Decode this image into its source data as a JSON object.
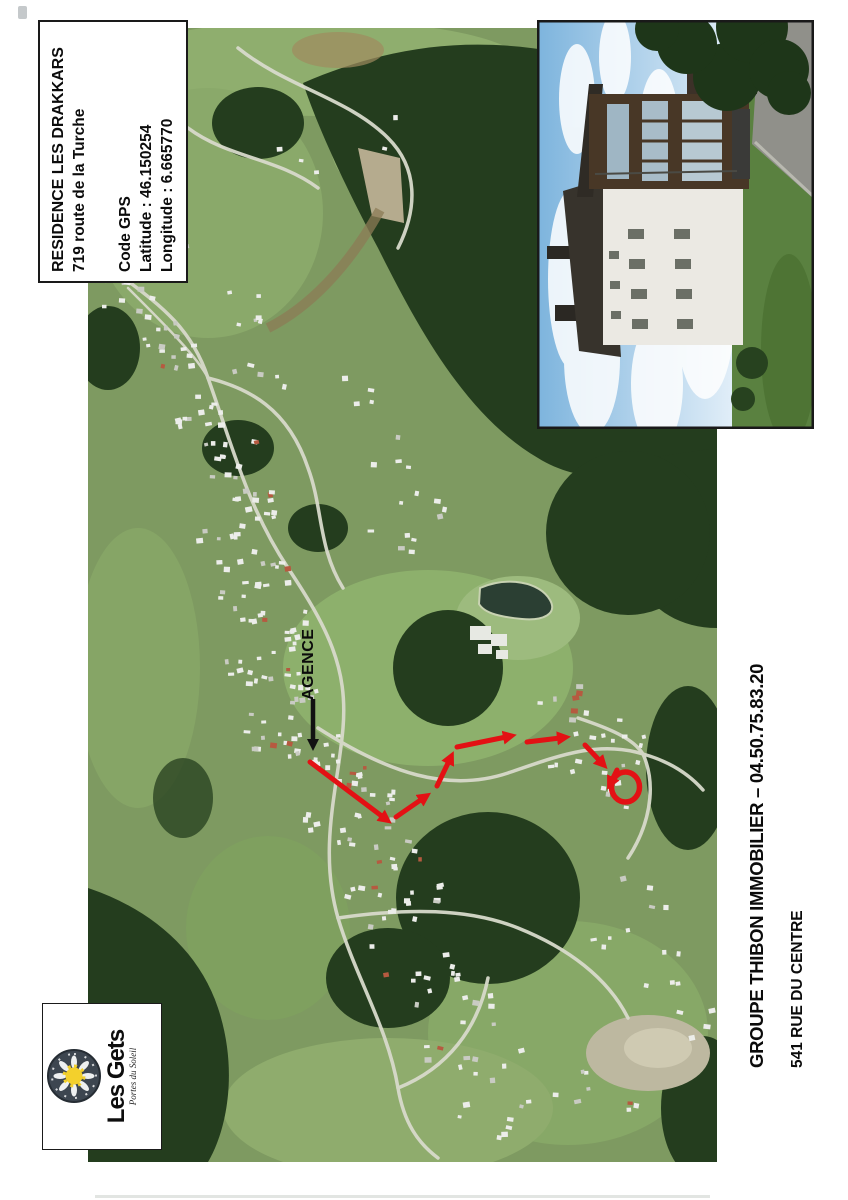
{
  "info_box": {
    "title": "RESIDENCE LES DRAKKARS",
    "address": "719 route de la Turche",
    "gps_heading": "Code GPS",
    "latitude": "Latitude : 46.150254",
    "longitude": "Longitude : 6.665770"
  },
  "map": {
    "agence_label": "AGENCE",
    "route_color": "#e31114",
    "arrow_color": "#121212"
  },
  "logo": {
    "name": "Les Gets",
    "tagline": "Portes du Soleil",
    "sun_color": "#f3d02c",
    "emblem_bg": "#3d4650"
  },
  "contact": {
    "agency": "GROUPE THIBON IMMOBILIER – 04.50.75.83.20",
    "address": "541 RUE DU CENTRE"
  }
}
